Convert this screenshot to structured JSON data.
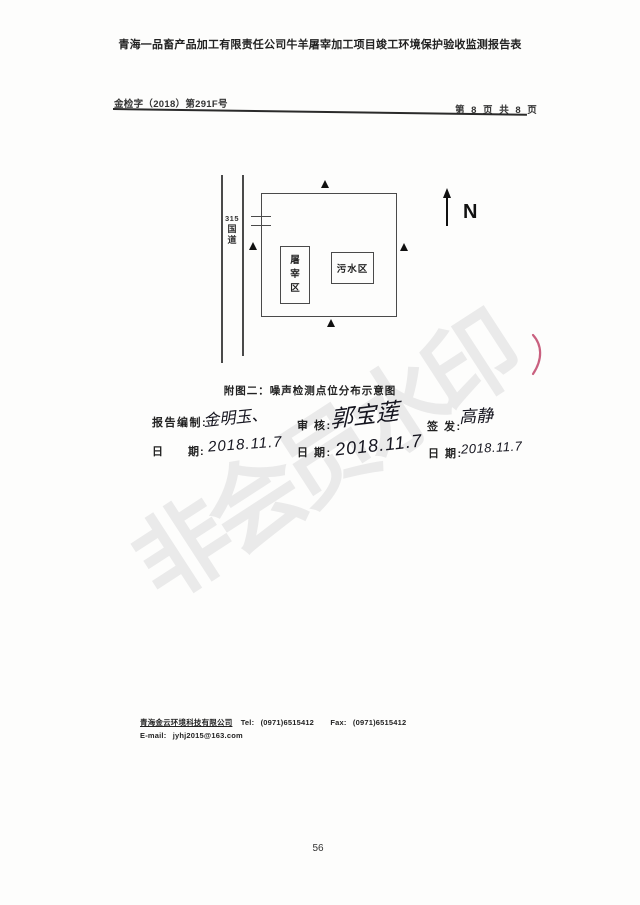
{
  "document": {
    "title": "青海一品畜产品加工有限责任公司牛羊屠宰加工项目竣工环境保护验收监测报告表",
    "doc_number": "金检字（2018）第291F号",
    "page_indicator": "第 8 页 共 8 页",
    "watermark": "非会员水印",
    "page_number": "56"
  },
  "figure": {
    "caption": "附图二：噪声检测点位分布示意图",
    "road_label_parts": [
      "315",
      "国",
      "道"
    ],
    "slaughter_area_chars": [
      "屠",
      "宰",
      "区"
    ],
    "sewage_area_label": "污水区",
    "north_label": "N",
    "noise_point_symbol": "▲",
    "noise_point_count": 4
  },
  "signoff": {
    "prepared_label": "报告编制:",
    "prepared_by": "金明玉、",
    "reviewed_label": "审 核:",
    "reviewed_by": "郭宝莲",
    "issued_label": "签 发:",
    "issued_by": "高静",
    "date_label_wide": "日　　期:",
    "date_label": "日 期:",
    "prepared_date": "2018.11.7",
    "reviewed_date": "2018.11.7",
    "issued_date": "2018.11.7"
  },
  "footer": {
    "company": "青海金云环境科技有限公司",
    "tel_label": "Tel:",
    "tel": "(0971)6515412",
    "fax_label": "Fax:",
    "fax": "(0971)6515412",
    "email_label": "E-mail:",
    "email": "jyhj2015@163.com"
  },
  "colors": {
    "ink": "#1a1a1a",
    "watermark_gray": "#eaeaea",
    "red_pen": "#bf4468"
  }
}
